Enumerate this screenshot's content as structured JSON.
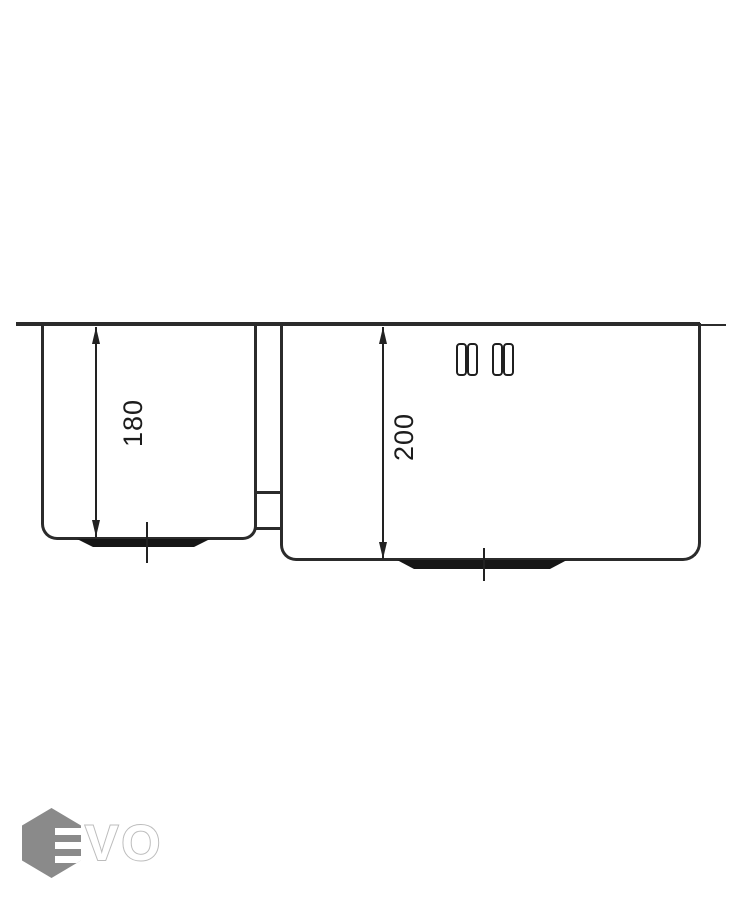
{
  "diagram": {
    "type": "technical-drawing",
    "subject": "double-bowl sink side section with depth dimensions",
    "dimensions": [
      {
        "id": "left-bowl-depth",
        "label": "180"
      },
      {
        "id": "right-bowl-depth",
        "label": "200"
      }
    ],
    "colors": {
      "line": "#2b2b2b",
      "background": "#ffffff"
    }
  },
  "logo": {
    "wordmark": "VO",
    "hexagon_color": "#8a8a8a",
    "letter_outline_color": "#bcbcbc"
  }
}
